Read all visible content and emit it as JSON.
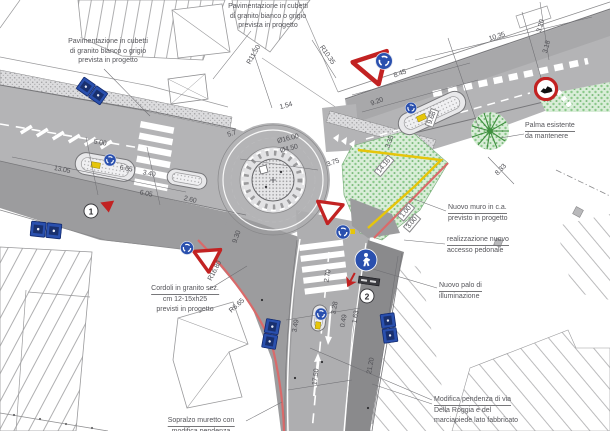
{
  "drawing": {
    "width": 610,
    "height": 431,
    "kind": "planimetria di progetto - rotatoria stradale"
  },
  "colors": {
    "road_light": "#b4b4b6",
    "road_mid": "#9c9c9e",
    "sidewalk_dark": "#8a8a8c",
    "green_dot": "#8bc98b",
    "sign_blue": "#2a50ae",
    "sign_red": "#c22222",
    "wall_red": "#d96a6a",
    "wall_yellow": "#e6c50a"
  },
  "annotations": [
    {
      "id": "pavimentazione-sx",
      "x": 108,
      "y": 37,
      "align": "center",
      "underline": false,
      "lines": [
        "Pavimentazione in cubetti",
        "di granito bianco o grigio",
        "prevista in progetto"
      ]
    },
    {
      "id": "pavimentazione-alto",
      "x": 268,
      "y": 2,
      "align": "center",
      "underline": false,
      "lines": [
        "Pavimentazione in cubetti",
        "di granito bianco o grigio",
        "prevista in progetto"
      ]
    },
    {
      "id": "palma",
      "x": 525,
      "y": 121,
      "align": "left",
      "underline": true,
      "lines": [
        "Palma esistente",
        "da mantenere"
      ]
    },
    {
      "id": "nuovo-muro",
      "x": 448,
      "y": 203,
      "align": "left",
      "underline": true,
      "lines": [
        "Nuovo muro in c.a.",
        "previsto in progetto"
      ]
    },
    {
      "id": "accesso-pedonale",
      "x": 447,
      "y": 235,
      "align": "left",
      "underline": true,
      "lines": [
        "realizzazione nuovo",
        "accesso pedonale"
      ]
    },
    {
      "id": "palo-illuminazione",
      "x": 439,
      "y": 281,
      "align": "left",
      "underline": true,
      "lines": [
        "Nuovo palo di",
        "illuminazione"
      ]
    },
    {
      "id": "cordoli",
      "x": 185,
      "y": 284,
      "align": "center",
      "underline": true,
      "lines": [
        "Cordoli in granito sez.",
        "cm 12-15xh25",
        "previsti in progetto"
      ]
    },
    {
      "id": "sopralzo",
      "x": 201,
      "y": 416,
      "align": "center",
      "underline": true,
      "lines": [
        "Sopralzo muretto con",
        "modifica pendenza"
      ]
    },
    {
      "id": "modifica-pendenza",
      "x": 434,
      "y": 395,
      "align": "left",
      "underline": true,
      "lines": [
        "Modifica pendenza di via",
        "Della Roggia e del",
        "marciapiede lato fabbricato"
      ]
    }
  ],
  "dimensions": [
    {
      "text": "13.05",
      "x": 62,
      "y": 170,
      "rot": 11
    },
    {
      "text": "5.00",
      "x": 100,
      "y": 143,
      "rot": 10
    },
    {
      "text": "6.65",
      "x": 126,
      "y": 169,
      "rot": 10
    },
    {
      "text": "3.40",
      "x": 149,
      "y": 174,
      "rot": 11
    },
    {
      "text": "6.05",
      "x": 146,
      "y": 194,
      "rot": 11
    },
    {
      "text": "2.60",
      "x": 190,
      "y": 200,
      "rot": 13
    },
    {
      "text": "R11.50",
      "x": 254,
      "y": 55,
      "rot": -60
    },
    {
      "text": "R10.35",
      "x": 327,
      "y": 55,
      "rot": 55
    },
    {
      "text": "10.35",
      "x": 497,
      "y": 37,
      "rot": -17
    },
    {
      "text": "8.45",
      "x": 400,
      "y": 74,
      "rot": -20
    },
    {
      "text": "9.20",
      "x": 377,
      "y": 102,
      "rot": -20
    },
    {
      "text": "9.68",
      "x": 432,
      "y": 118,
      "rot": -70,
      "boxed": true
    },
    {
      "text": "3.20",
      "x": 541,
      "y": 26,
      "rot": -75
    },
    {
      "text": "3.18",
      "x": 547,
      "y": 47,
      "rot": -75
    },
    {
      "text": "1.54",
      "x": 286,
      "y": 106,
      "rot": -15
    },
    {
      "text": "Ø16.00",
      "x": 288,
      "y": 139,
      "rot": -14
    },
    {
      "text": "Ø4.50",
      "x": 289,
      "y": 149,
      "rot": -14
    },
    {
      "text": "5.7",
      "x": 232,
      "y": 134,
      "rot": -18
    },
    {
      "text": "3.75",
      "x": 333,
      "y": 163,
      "rot": -20
    },
    {
      "text": "3.35",
      "x": 390,
      "y": 142,
      "rot": -70
    },
    {
      "text": "8.33",
      "x": 501,
      "y": 170,
      "rot": -46
    },
    {
      "text": "14.16",
      "x": 384,
      "y": 166,
      "rot": -50,
      "boxed": true
    },
    {
      "text": "1.00",
      "x": 406,
      "y": 212,
      "rot": -50,
      "boxed": true
    },
    {
      "text": "3.00",
      "x": 412,
      "y": 223,
      "rot": -50,
      "boxed": true
    },
    {
      "text": "R16.80",
      "x": 215,
      "y": 271,
      "rot": -62
    },
    {
      "text": "R6.65",
      "x": 237,
      "y": 306,
      "rot": -42
    },
    {
      "text": "9.30",
      "x": 237,
      "y": 237,
      "rot": -70
    },
    {
      "text": "17.50",
      "x": 316,
      "y": 377,
      "rot": -83
    },
    {
      "text": "21.20",
      "x": 371,
      "y": 366,
      "rot": -80
    },
    {
      "text": "3.49",
      "x": 296,
      "y": 326,
      "rot": -80
    },
    {
      "text": "3.28",
      "x": 335,
      "y": 308,
      "rot": -80
    },
    {
      "text": "0.49",
      "x": 344,
      "y": 321,
      "rot": -80
    },
    {
      "text": "1.63",
      "x": 356,
      "y": 317,
      "rot": -80
    },
    {
      "text": "2.70",
      "x": 328,
      "y": 276,
      "rot": -80
    }
  ],
  "markers": [
    {
      "label": "1",
      "x": 91,
      "y": 211
    },
    {
      "label": "2",
      "x": 367,
      "y": 296
    }
  ],
  "signs": [
    {
      "type": "yield",
      "name": "yield-sign",
      "x": 374,
      "y": 70,
      "rot": -18,
      "scale": 1.0
    },
    {
      "type": "yield",
      "name": "yield-sign",
      "x": 329,
      "y": 213,
      "rot": 8,
      "scale": 0.72
    },
    {
      "type": "yield",
      "name": "yield-sign",
      "x": 208,
      "y": 261,
      "rot": -4,
      "scale": 0.75
    },
    {
      "type": "yield-solid",
      "name": "yield-marker",
      "x": 108,
      "y": 207,
      "rot": -8,
      "scale": 1
    },
    {
      "type": "round-blue",
      "name": "roundabout-sign",
      "x": 384,
      "y": 61,
      "rot": 0,
      "scale": 1.0
    },
    {
      "type": "round-blue",
      "name": "roundabout-sign",
      "x": 411,
      "y": 108,
      "rot": 0,
      "scale": 0.68
    },
    {
      "type": "round-blue",
      "name": "roundabout-sign",
      "x": 110,
      "y": 160,
      "rot": 0,
      "scale": 0.72
    },
    {
      "type": "round-blue",
      "name": "roundabout-sign",
      "x": 343,
      "y": 232,
      "rot": 0,
      "scale": 0.84
    },
    {
      "type": "round-blue",
      "name": "roundabout-sign",
      "x": 187,
      "y": 248,
      "rot": 0,
      "scale": 0.78
    },
    {
      "type": "round-blue",
      "name": "roundabout-sign",
      "x": 321,
      "y": 314,
      "rot": 0,
      "scale": 0.72
    },
    {
      "type": "pedestrian",
      "name": "pedestrian-crossing-sign",
      "x": 366,
      "y": 260,
      "rot": 0,
      "scale": 1.05
    },
    {
      "type": "prohibition",
      "name": "no-transit-sign",
      "x": 546,
      "y": 89,
      "rot": 0,
      "scale": 1
    },
    {
      "type": "blue-pair-h",
      "name": "parking-signs",
      "x": 92,
      "y": 91,
      "rot": 35,
      "scale": 1
    },
    {
      "type": "blue-pair-h",
      "name": "parking-signs",
      "x": 46,
      "y": 230,
      "rot": 6,
      "scale": 1.05
    },
    {
      "type": "blue-pair-v",
      "name": "parking-signs",
      "x": 271,
      "y": 334,
      "rot": 10,
      "scale": 1
    },
    {
      "type": "blue-pair-v",
      "name": "parking-signs",
      "x": 389,
      "y": 328,
      "rot": -8,
      "scale": 1
    },
    {
      "type": "red-arrow",
      "name": "direction-arrow",
      "x": 351,
      "y": 280,
      "rot": 28,
      "scale": 1
    },
    {
      "type": "plate-dark",
      "name": "street-name-plate",
      "x": 369,
      "y": 281,
      "rot": 8,
      "scale": 1
    }
  ]
}
